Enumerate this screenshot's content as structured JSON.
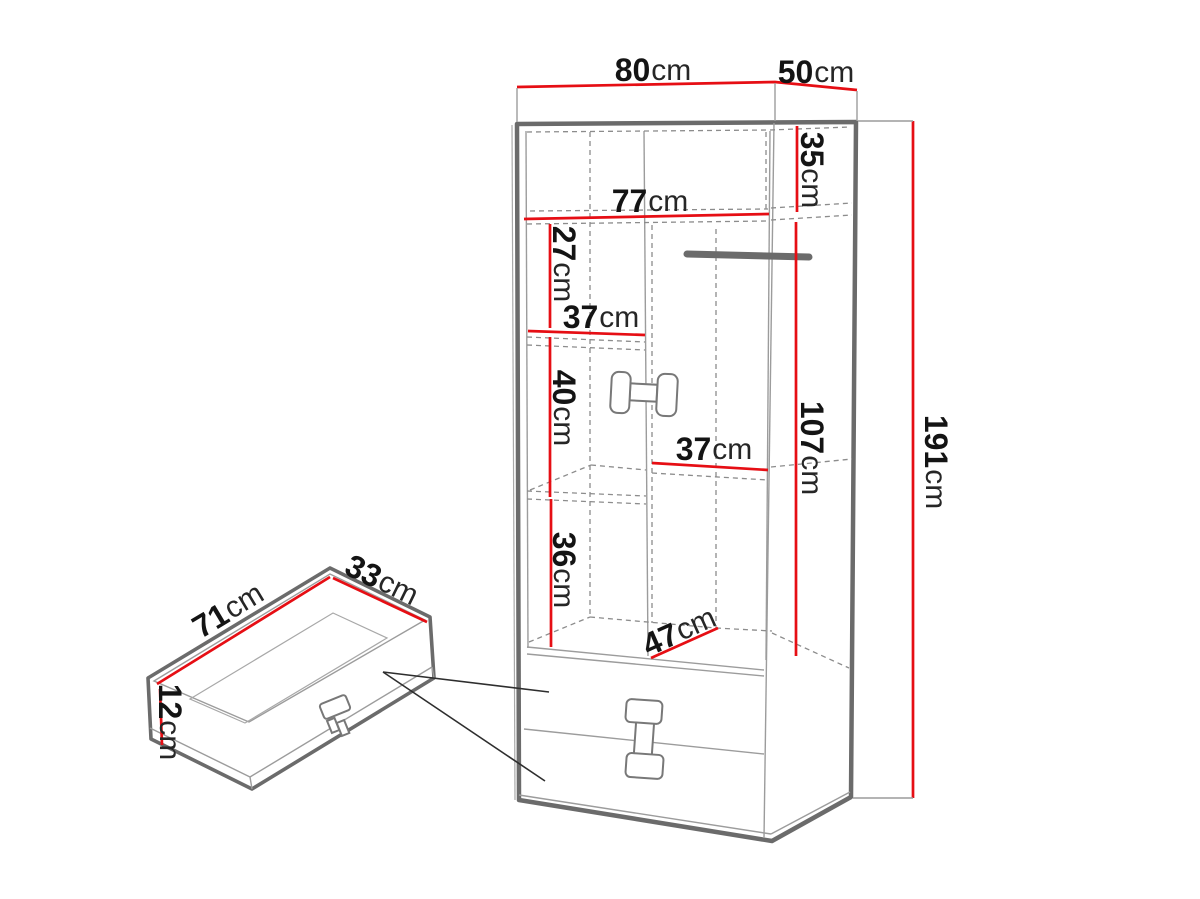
{
  "diagram": {
    "kind": "furniture-dimension-drawing",
    "units": "cm",
    "colors": {
      "dimension_red": "#e60e14",
      "outline_gray": "#6b6b6b",
      "dashed_gray": "#8c8c8c",
      "text_black": "#1a1a1a"
    },
    "dims": {
      "width": {
        "num": "80",
        "unit": "cm"
      },
      "depth": {
        "num": "50",
        "unit": "cm"
      },
      "top_section_height": {
        "num": "35",
        "unit": "cm"
      },
      "interior_width": {
        "num": "77",
        "unit": "cm"
      },
      "upper_shelf_gap": {
        "num": "27",
        "unit": "cm"
      },
      "left_shelf_width": {
        "num": "37",
        "unit": "cm"
      },
      "middle_shelf_gap": {
        "num": "40",
        "unit": "cm"
      },
      "right_shelf_width": {
        "num": "37",
        "unit": "cm"
      },
      "lower_shelf_gap": {
        "num": "36",
        "unit": "cm"
      },
      "interior_depth": {
        "num": "47",
        "unit": "cm"
      },
      "hanging_section_height": {
        "num": "107",
        "unit": "cm"
      },
      "total_height": {
        "num": "191",
        "unit": "cm"
      },
      "drawer_width": {
        "num": "71",
        "unit": "cm"
      },
      "drawer_depth": {
        "num": "33",
        "unit": "cm"
      },
      "drawer_height": {
        "num": "12",
        "unit": "cm"
      }
    }
  }
}
